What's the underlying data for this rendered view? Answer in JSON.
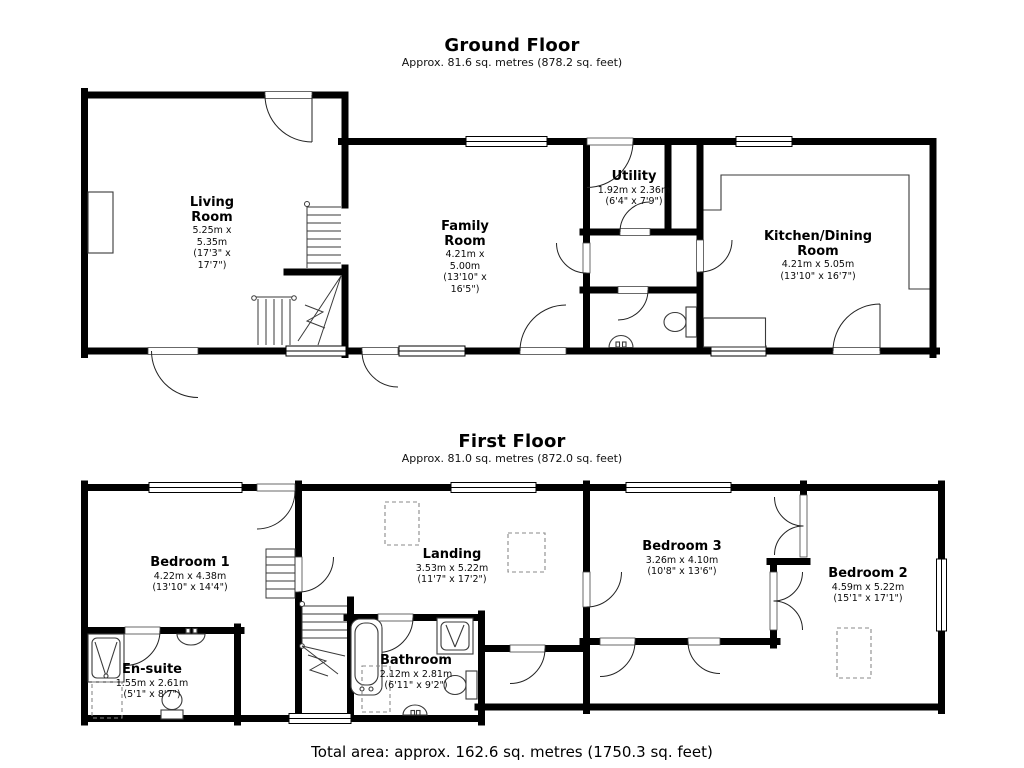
{
  "ground_floor": {
    "title": "Ground Floor",
    "subtitle": "Approx. 81.6 sq. metres (878.2 sq. feet)",
    "rooms": {
      "living": {
        "name": "Living Room",
        "metric": "5.25m x 5.35m",
        "imperial": "(17'3\" x 17'7\")"
      },
      "family": {
        "name": "Family Room",
        "metric": "4.21m x 5.00m",
        "imperial": "(13'10\" x 16'5\")"
      },
      "utility": {
        "name": "Utility",
        "metric": "1.92m x 2.36m",
        "imperial": "(6'4\" x 7'9\")"
      },
      "kitchen": {
        "name": "Kitchen/Dining Room",
        "metric": "4.21m x 5.05m",
        "imperial": "(13'10\" x 16'7\")"
      }
    }
  },
  "first_floor": {
    "title": "First Floor",
    "subtitle": "Approx. 81.0 sq. metres (872.0 sq. feet)",
    "rooms": {
      "bedroom1": {
        "name": "Bedroom 1",
        "metric": "4.22m x 4.38m",
        "imperial": "(13'10\" x 14'4\")"
      },
      "landing": {
        "name": "Landing",
        "metric": "3.53m x 5.22m",
        "imperial": "(11'7\" x 17'2\")"
      },
      "bedroom3": {
        "name": "Bedroom 3",
        "metric": "3.26m x 4.10m",
        "imperial": "(10'8\" x 13'6\")"
      },
      "bedroom2": {
        "name": "Bedroom 2",
        "metric": "4.59m x 5.22m",
        "imperial": "(15'1\" x 17'1\")"
      },
      "ensuite": {
        "name": "En-suite",
        "metric": "1.55m x 2.61m",
        "imperial": "(5'1\" x 8'7\")"
      },
      "bathroom": {
        "name": "Bathroom",
        "metric": "2.12m x 2.81m",
        "imperial": "(6'11\" x 9'2\")"
      }
    }
  },
  "footer": {
    "total_area": "Total area: approx. 162.6 sq. metres (1750.3 sq. feet)"
  },
  "colors": {
    "wall": "#000000",
    "fixture_line": "#3a3a3a",
    "dashed_line": "#8a8a8a",
    "background": "#ffffff"
  }
}
